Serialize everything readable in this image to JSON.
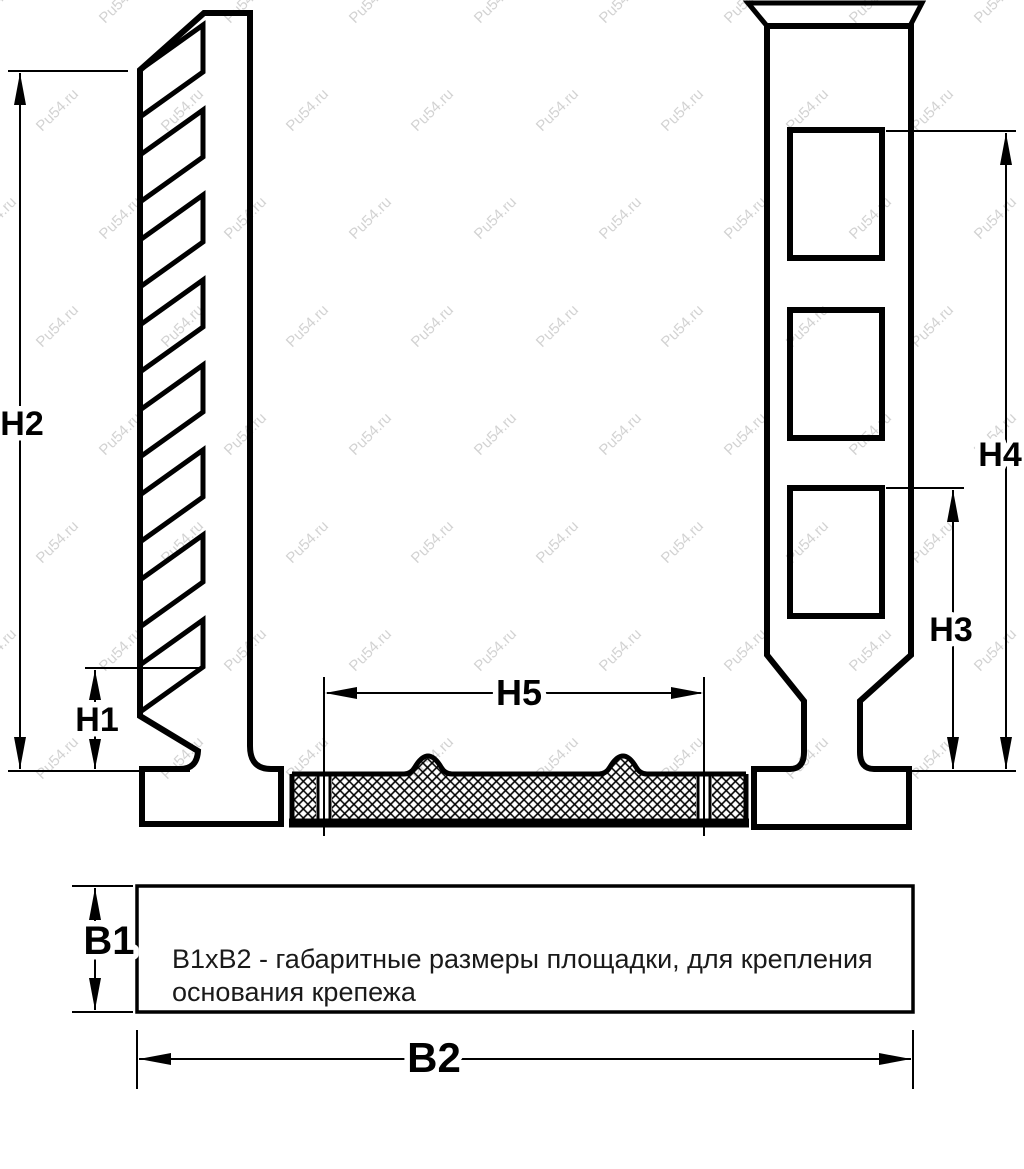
{
  "drawing": {
    "labels": {
      "h1": "H1",
      "h2": "H2",
      "h3": "H3",
      "h4": "H4",
      "h5": "H5",
      "b1": "B1",
      "b2": "B2"
    },
    "note": {
      "line1": "В1хВ2 - габаритные размеры площадки, для крепления",
      "line2": "основания крепежа"
    },
    "watermark": {
      "text": "Pu54.ru"
    },
    "colors": {
      "ink": "#000000",
      "watermark": "#8a8a8a",
      "background": "#ffffff"
    }
  }
}
